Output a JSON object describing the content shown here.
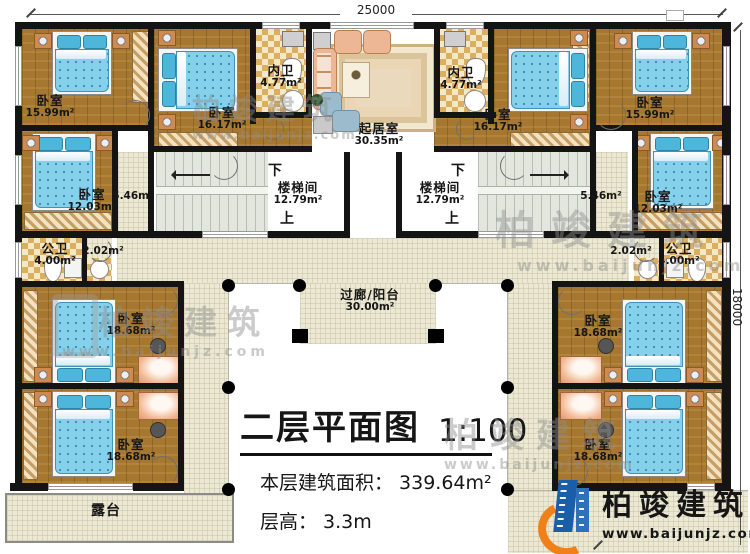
{
  "plan": {
    "dimensions": {
      "top": "25000",
      "right": "18000"
    },
    "rooms": {
      "bedroom_tl": {
        "name": "卧室",
        "area": "15.99m²"
      },
      "bedroom_tr": {
        "name": "卧室",
        "area": "15.99m²"
      },
      "bedroom_tcl": {
        "name": "卧室",
        "area": "16.17m²"
      },
      "bedroom_tcr": {
        "name": "卧室",
        "area": "16.17m²"
      },
      "bath_inner_l": {
        "name": "内卫",
        "area": "4.77m²"
      },
      "bath_inner_r": {
        "name": "内卫",
        "area": "4.77m²"
      },
      "living": {
        "name": "起居室",
        "area": "30.35m²"
      },
      "stair_l": {
        "name": "楼梯间",
        "area": "12.79m²"
      },
      "stair_r": {
        "name": "楼梯间",
        "area": "12.79m²"
      },
      "corridor_l": {
        "area": "5.46m²"
      },
      "corridor_r": {
        "area": "5.46m²"
      },
      "bedroom_ml": {
        "name": "卧室",
        "area": "12.03m²"
      },
      "bedroom_mr": {
        "name": "卧室",
        "area": "12.03m²"
      },
      "bath_public_l": {
        "name": "公卫",
        "area": "4.00m²"
      },
      "bath_public_r": {
        "name": "公卫",
        "area": "4.00m²"
      },
      "hall_l": {
        "area": "2.02m²"
      },
      "hall_r": {
        "area": "2.02m²"
      },
      "balcony": {
        "name": "过廊/阳台",
        "area": "30.00m²"
      },
      "bedroom_bl1": {
        "name": "卧室",
        "area": "18.68m²"
      },
      "bedroom_bl2": {
        "name": "卧室",
        "area": "18.68m²"
      },
      "bedroom_br1": {
        "name": "卧室",
        "area": "18.68m²"
      },
      "bedroom_br2": {
        "name": "卧室",
        "area": "18.68m²"
      },
      "terrace": {
        "name": "露台"
      }
    },
    "stair_marks": {
      "down": "下",
      "up": "上"
    }
  },
  "title_block": {
    "title": "二层平面图",
    "scale": "1:100",
    "area_label": "本层建筑面积：",
    "area_value": "339.64m²",
    "height_label": "层高：",
    "height_value": "3.3m"
  },
  "brand": {
    "name": "柏竣建筑",
    "url": "www.baijunjz.com"
  },
  "colors": {
    "wall": "#141414",
    "wood_floor": "#a6772f",
    "tile_floor": "#ebe8d3",
    "stair_floor": "#e2e6de",
    "bed_blanket": "#85d0ea",
    "bath_checker": "#dcae60",
    "logo_blue": "#1a5da8",
    "logo_orange": "#f08019"
  }
}
